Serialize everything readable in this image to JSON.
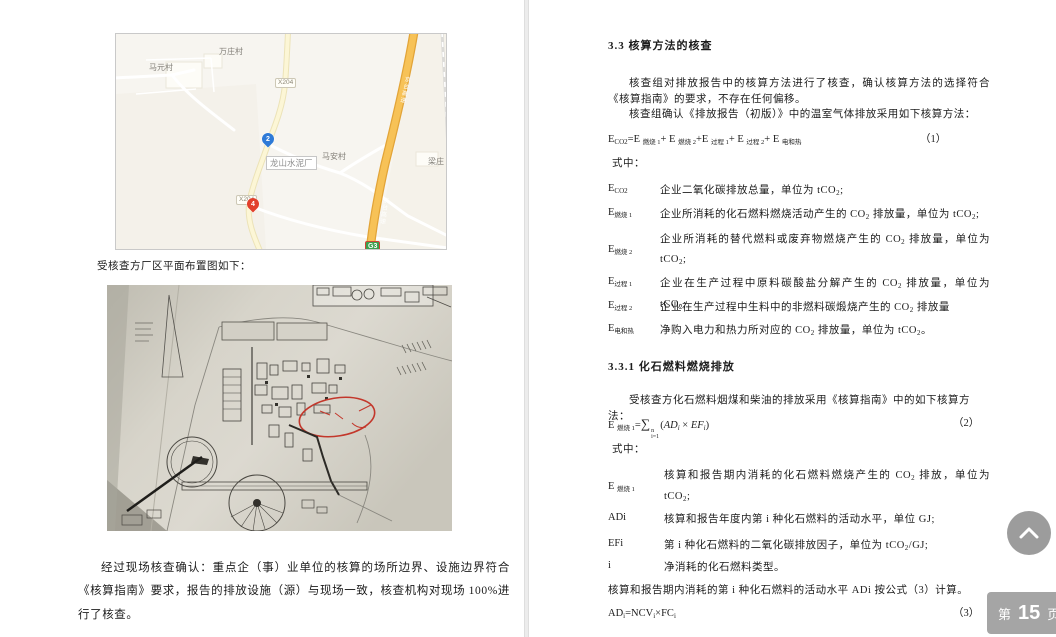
{
  "left_page": {
    "map": {
      "villages": [
        "万庄村",
        "马元村",
        "马安村",
        "梁庄"
      ],
      "road_badge_1": "X204",
      "road_badge_2": "X204",
      "expressway_badge": "G3",
      "expressway_name": "京台高速",
      "marker_blue_label": "2",
      "marker_red_label": "4",
      "place_label": "龙山水泥厂"
    },
    "caption": "受核查方厂区平面布置图如下：",
    "closing_paragraph": "经过现场核查确认：重点企（事）业单位的核算的场所边界、设施边界符合《核算指南》要求，报告的排放设施（源）与现场一致，核查机构对现场 100%进行了核查。"
  },
  "right_page": {
    "section_heading": "3.3  核算方法的核查",
    "para_1": "核查组对排放报告中的核算方法进行了核查，确认核算方法的选择符合《核算指南》的要求，不存在任何偏移。",
    "para_2": "核查组确认《排放报告（初版）》中的温室气体排放采用如下核算方法：",
    "formula_1": {
      "lhs_base": "E",
      "lhs_sub": "CO2",
      "rhs": [
        {
          "t": "=E ",
          "s": "燃烧 1"
        },
        {
          "t": "+ E ",
          "s": "燃烧 2"
        },
        {
          "t": "+E ",
          "s": "过程 1"
        },
        {
          "t": "+ E ",
          "s": "过程 2"
        },
        {
          "t": "+ E ",
          "s": "电和热"
        }
      ],
      "number": "（1）"
    },
    "where_1": "式中：",
    "definitions_1": [
      {
        "term_base": "E",
        "term_sub": "CO2",
        "def": "企业二氧化碳排放总量，单位为 tCO2;"
      },
      {
        "term_base": "E",
        "term_sub": "燃烧 1",
        "def": "企业所消耗的化石燃料燃烧活动产生的 CO2 排放量，单位为 tCO2;"
      },
      {
        "term_base": "E",
        "term_sub": "燃烧 2",
        "def": "企业所消耗的替代燃料或废弃物燃烧产生的 CO2 排放量，单位为 tCO2;"
      },
      {
        "term_base": "E",
        "term_sub": "过程 1",
        "def": "企业在生产过程中原料碳酸盐分解产生的 CO2 排放量，单位为 tCO2;"
      },
      {
        "term_base": "E",
        "term_sub": "过程 2",
        "def": "企业在生产过程中生料中的非燃料碳煅烧产生的 CO2 排放量"
      },
      {
        "term_base": "E",
        "term_sub": "电和热",
        "def": "净购入电力和热力所对应的 CO2 排放量，单位为 tCO2。"
      }
    ],
    "subsection_heading": "3.3.1  化石燃料燃烧排放",
    "subsection_para": "受核查方化石燃料烟煤和柴油的排放采用《核算指南》中的如下核算方法：",
    "formula_2": {
      "lhs_base": "E ",
      "lhs_sub": "燃烧 1",
      "eq": "=",
      "sigma": "∑",
      "upper": "n",
      "lower": "i=1",
      "open": "(",
      "var_a": "AD",
      "sub_a": "i",
      "times": " × ",
      "var_b": "EF",
      "sub_b": "i",
      "close": ")",
      "number": "（2）"
    },
    "where_2": "式中：",
    "definitions_2": [
      {
        "term_base": "E ",
        "term_sub": "燃烧 1",
        "def": "核算和报告期内消耗的化石燃料燃烧产生的 CO2 排放，单位为 tCO2;"
      },
      {
        "term_base": "ADi",
        "term_sub": "",
        "def": "核算和报告年度内第 i 种化石燃料的活动水平，单位 GJ;"
      },
      {
        "term_base": "EFi",
        "term_sub": "",
        "def": "第 i 种化石燃料的二氧化碳排放因子，单位为 tCO2/GJ;"
      },
      {
        "term_base": "i",
        "term_sub": "",
        "def": "净消耗的化石燃料类型。"
      }
    ],
    "ad_sentence": "核算和报告期内消耗的第 i 种化石燃料的活动水平 ADi 按公式（3）计算。",
    "formula_3": {
      "a": "AD",
      "ai": "i",
      "b": "=NCV",
      "bi": "i",
      "times": "×",
      "c": "FC",
      "ci": "i",
      "number": "（3）"
    }
  },
  "overlay": {
    "page_badge": {
      "prefix": "第",
      "number": "15",
      "suffix": "页"
    },
    "scroll_top_icon": "chevron-up"
  }
}
